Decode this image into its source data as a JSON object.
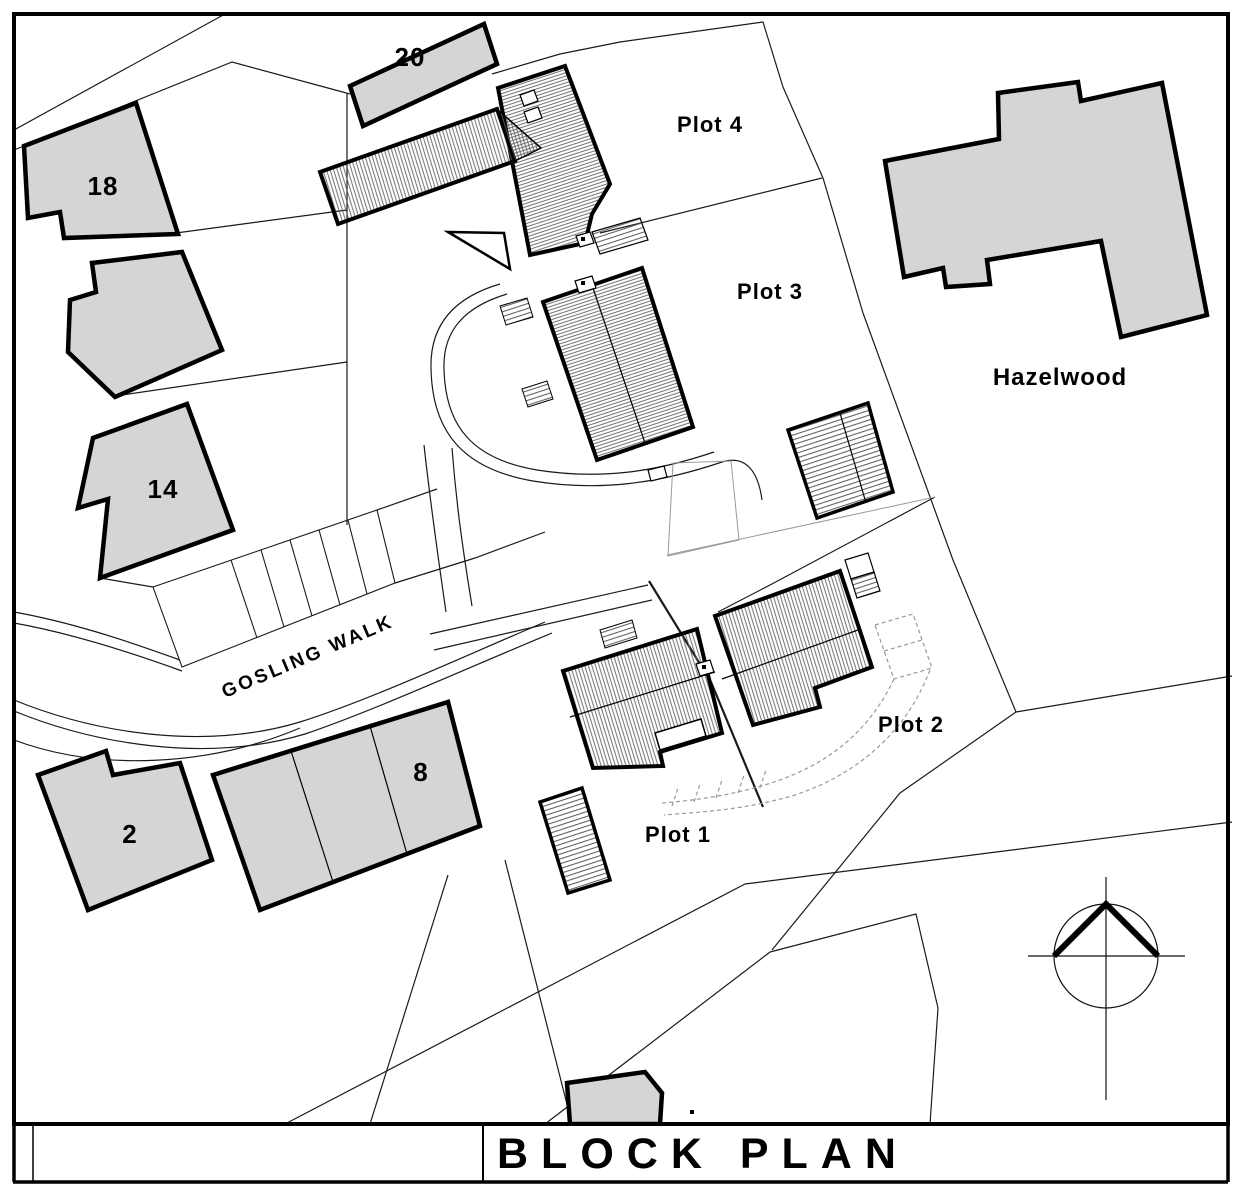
{
  "drawing": {
    "title": "BLOCK PLAN",
    "street_label": "GOSLING WALK",
    "neighbor_label": "Hazelwood",
    "plots": [
      {
        "label": "Plot 1"
      },
      {
        "label": "Plot 2"
      },
      {
        "label": "Plot 3"
      },
      {
        "label": "Plot 4"
      }
    ],
    "existing_houses": [
      {
        "label": "2"
      },
      {
        "label": "8"
      },
      {
        "label": "14"
      },
      {
        "label": "18"
      },
      {
        "label": "20"
      }
    ],
    "colors": {
      "existing_building_fill": "#d5d5d5",
      "outline": "#000000",
      "hatch_line": "#5f5f5f",
      "boundary_line": "#1a1a1a",
      "background": "#ffffff"
    }
  }
}
